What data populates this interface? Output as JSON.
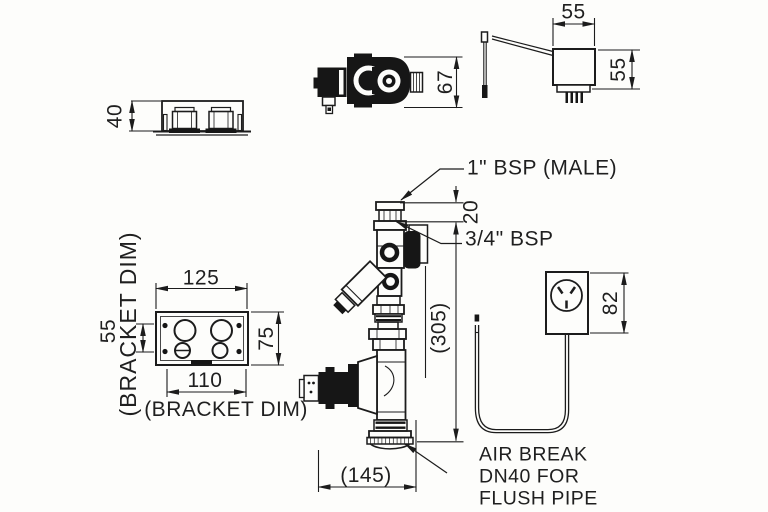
{
  "drawing": {
    "labels": {
      "inlet_male": "1\" BSP (MALE)",
      "outlet_bsp": "3/4\" BSP",
      "air_break_line1": "AIR BREAK",
      "air_break_line2": "DN40 FOR",
      "air_break_line3": "FLUSH PIPE",
      "bracket_dim_left": "(BRACKET DIM)",
      "bracket_dim_bottom": "(BRACKET DIM)"
    },
    "dimensions": {
      "bracket_side_height": "40",
      "solenoid_valve_height": "67",
      "transformer_width": "55",
      "transformer_height": "55",
      "plate_width_top": "125",
      "plate_hole_spacing": "55",
      "plate_height": "75",
      "plate_width_bottom": "110",
      "inlet_thread_length": "20",
      "assembly_height": "(305)",
      "assembly_width": "(145)",
      "outlet_box_height": "82"
    },
    "colors": {
      "line": "#1c1c1c",
      "background": "#fdfdfb"
    }
  }
}
